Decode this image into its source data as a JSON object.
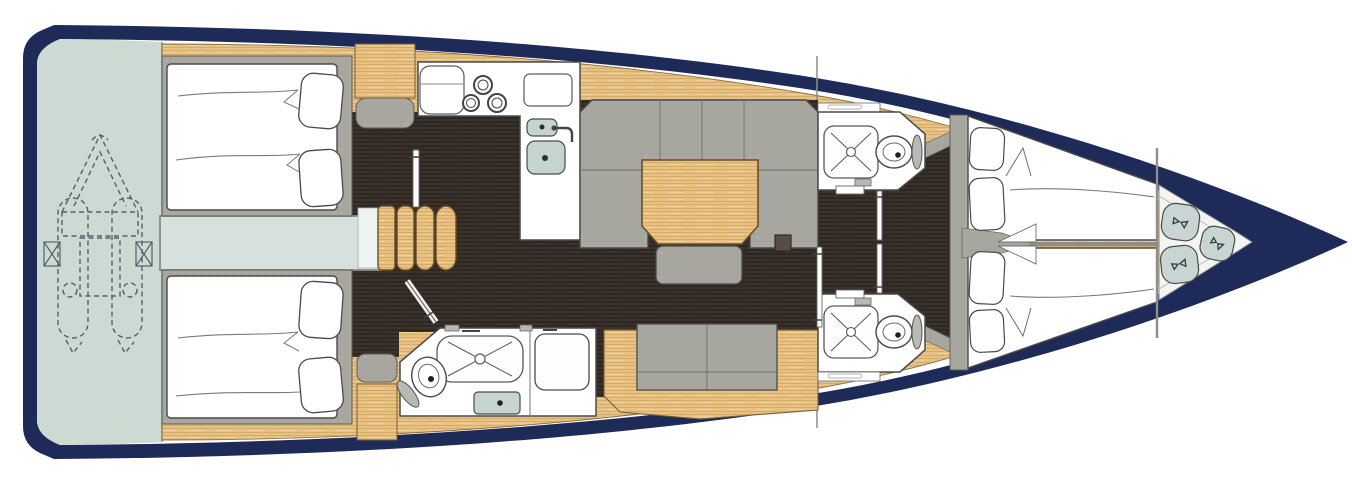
{
  "meta": {
    "diagram_type": "sailing-yacht-interior-deck-plan",
    "orientation": "bow-right-stern-left",
    "visible_text": "none"
  },
  "palette": {
    "hull_navy": "#1e2a58",
    "deck_wood": "#e8c183",
    "wood_grain": "#c2954e",
    "floor_dark": "#3a322b",
    "floor_grain": "#262019",
    "upholstery_gray": "#a7a7a0",
    "platform_pale": "#cdd9d3",
    "engine_pale": "#d6e1dd",
    "fixture_white": "#ffffff",
    "sink_green": "#c6d4d0",
    "cushion_pale": "#c8d5d3",
    "outline": "#4a4a4a"
  },
  "rooms": [
    {
      "name": "swim-platform",
      "position": "stern",
      "features": [
        "tender-dinghy-dashed-outline",
        "davit-brackets"
      ]
    },
    {
      "name": "aft-cabin-port",
      "position": "aft-top",
      "features": [
        "double-berth",
        "two-pillows"
      ]
    },
    {
      "name": "aft-cabin-starboard",
      "position": "aft-bottom",
      "features": [
        "double-berth",
        "two-pillows"
      ]
    },
    {
      "name": "engine-compartment",
      "position": "aft-centerline",
      "features": []
    },
    {
      "name": "companionway",
      "position": "centerline",
      "features": [
        "four-steps"
      ]
    },
    {
      "name": "galley",
      "position": "midship-port",
      "features": [
        "three-burner-stove",
        "double-sink",
        "faucet",
        "counter",
        "worktop-board"
      ]
    },
    {
      "name": "aft-head-starboard",
      "position": "midship-bottom",
      "features": [
        "shower-tray",
        "toilet",
        "washbasin",
        "shower-stall"
      ]
    },
    {
      "name": "salon",
      "position": "midship",
      "features": [
        "u-shaped-sofa",
        "dining-table",
        "stool",
        "floor-hatch",
        "side-bench"
      ]
    },
    {
      "name": "head-port",
      "position": "forward-top",
      "features": [
        "shower-tray",
        "toilet",
        "vanity-shelf",
        "door"
      ]
    },
    {
      "name": "head-starboard",
      "position": "forward-bottom",
      "features": [
        "shower-tray",
        "toilet",
        "vanity-shelf",
        "door"
      ]
    },
    {
      "name": "forward-cabin",
      "position": "bow",
      "features": [
        "v-berth-port",
        "v-berth-starboard",
        "four-pillows",
        "center-divider"
      ]
    },
    {
      "name": "bow-locker",
      "position": "bow-tip",
      "features": [
        "three-seat-cushions"
      ]
    }
  ],
  "fixture_icons": [
    "stove-burners-icon",
    "sink-icon",
    "faucet-icon",
    "shower-tray-icon",
    "toilet-icon",
    "washbasin-icon",
    "stairs-icon",
    "tender-outline-icon",
    "bow-cushion-icon",
    "door-leaf-icon",
    "floor-hatch-icon"
  ],
  "counts": {
    "cabins": 3,
    "heads": 3,
    "berth_pillows": 8,
    "bow_cushions": 3,
    "stove_burners": 3,
    "companionway_steps": 4
  }
}
